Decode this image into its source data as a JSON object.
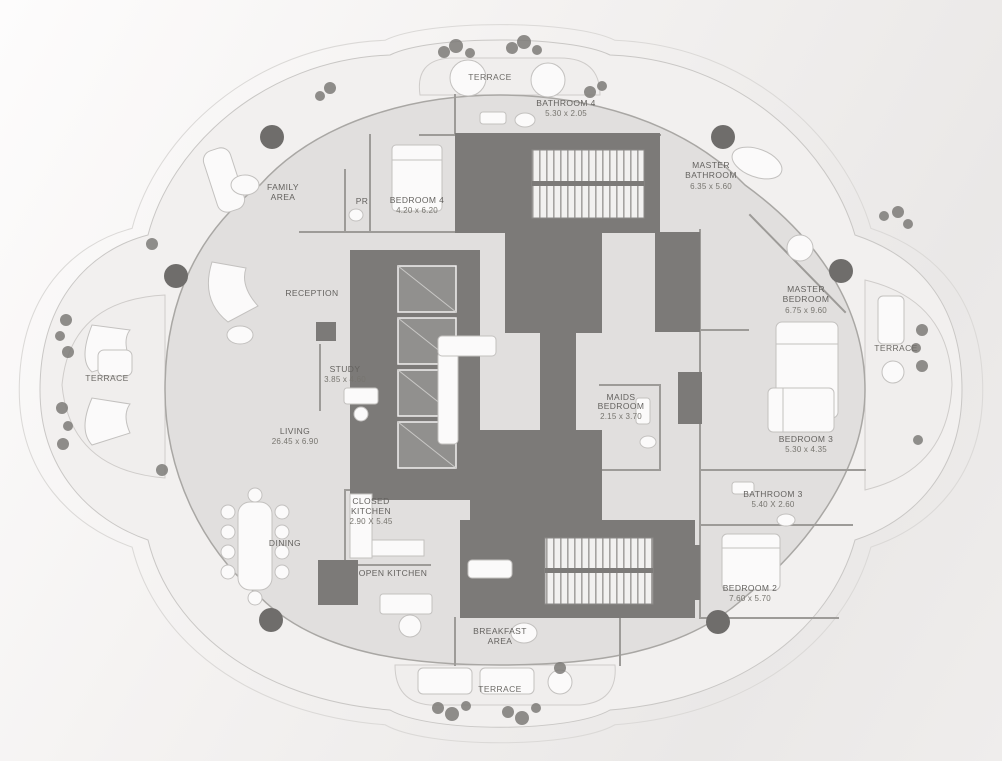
{
  "plan_title": "Penthouse floor plan",
  "colors": {
    "background_light": "#fdfcfc",
    "background_dark": "#eae8e7",
    "terrace_band": "#f0eeed",
    "floor_plate": "#e1dfde",
    "core_dark": "#7c7a78",
    "wall": "#9d9b98",
    "furniture_fill": "#fbfafa",
    "furniture_stroke": "#c3c1bf",
    "column": "#6f6d6b",
    "plant": "#7d7b78",
    "label_text": "#64625f"
  },
  "terraces": {
    "top": "TERRACE",
    "left": "TERRACE",
    "right": "TERRACE",
    "bottom": "TERRACE"
  },
  "rooms": {
    "bathroom4": {
      "name": "BATHROOM 4",
      "dim": "5.30 x 2.05"
    },
    "family_area": {
      "l1": "FAMILY",
      "l2": "AREA"
    },
    "pr": {
      "name": "PR"
    },
    "bedroom4": {
      "name": "BEDROOM 4",
      "dim": "4.20 x 6.20"
    },
    "master_bathroom": {
      "l1": "MASTER",
      "l2": "BATHROOM",
      "dim": "6.35 x 5.60"
    },
    "reception": {
      "name": "RECEPTION"
    },
    "master_bedroom": {
      "l1": "MASTER",
      "l2": "BEDROOM",
      "dim": "6.75 x 9.60"
    },
    "study": {
      "name": "STUDY",
      "dim": "3.85 x 4.60"
    },
    "maids_bedroom": {
      "l1": "MAIDS",
      "l2": "BEDROOM",
      "dim": "2.15 x 3.70"
    },
    "living": {
      "name": "LIVING",
      "dim": "26.45 x 6.90"
    },
    "bedroom3": {
      "name": "BEDROOM 3",
      "dim": "5.30 x 4.35"
    },
    "bathroom3": {
      "name": "BATHROOM 3",
      "dim": "5.40 X 2.60"
    },
    "closed_kitchen": {
      "l1": "CLOSED",
      "l2": "KITCHEN",
      "dim": "2.90 X 5.45"
    },
    "dining": {
      "name": "DINING"
    },
    "open_kitchen": {
      "name": "OPEN KITCHEN"
    },
    "bedroom2": {
      "name": "BEDROOM 2",
      "dim": "7.60 x 5.70"
    },
    "breakfast_area": {
      "l1": "BREAKFAST",
      "l2": "AREA"
    }
  }
}
